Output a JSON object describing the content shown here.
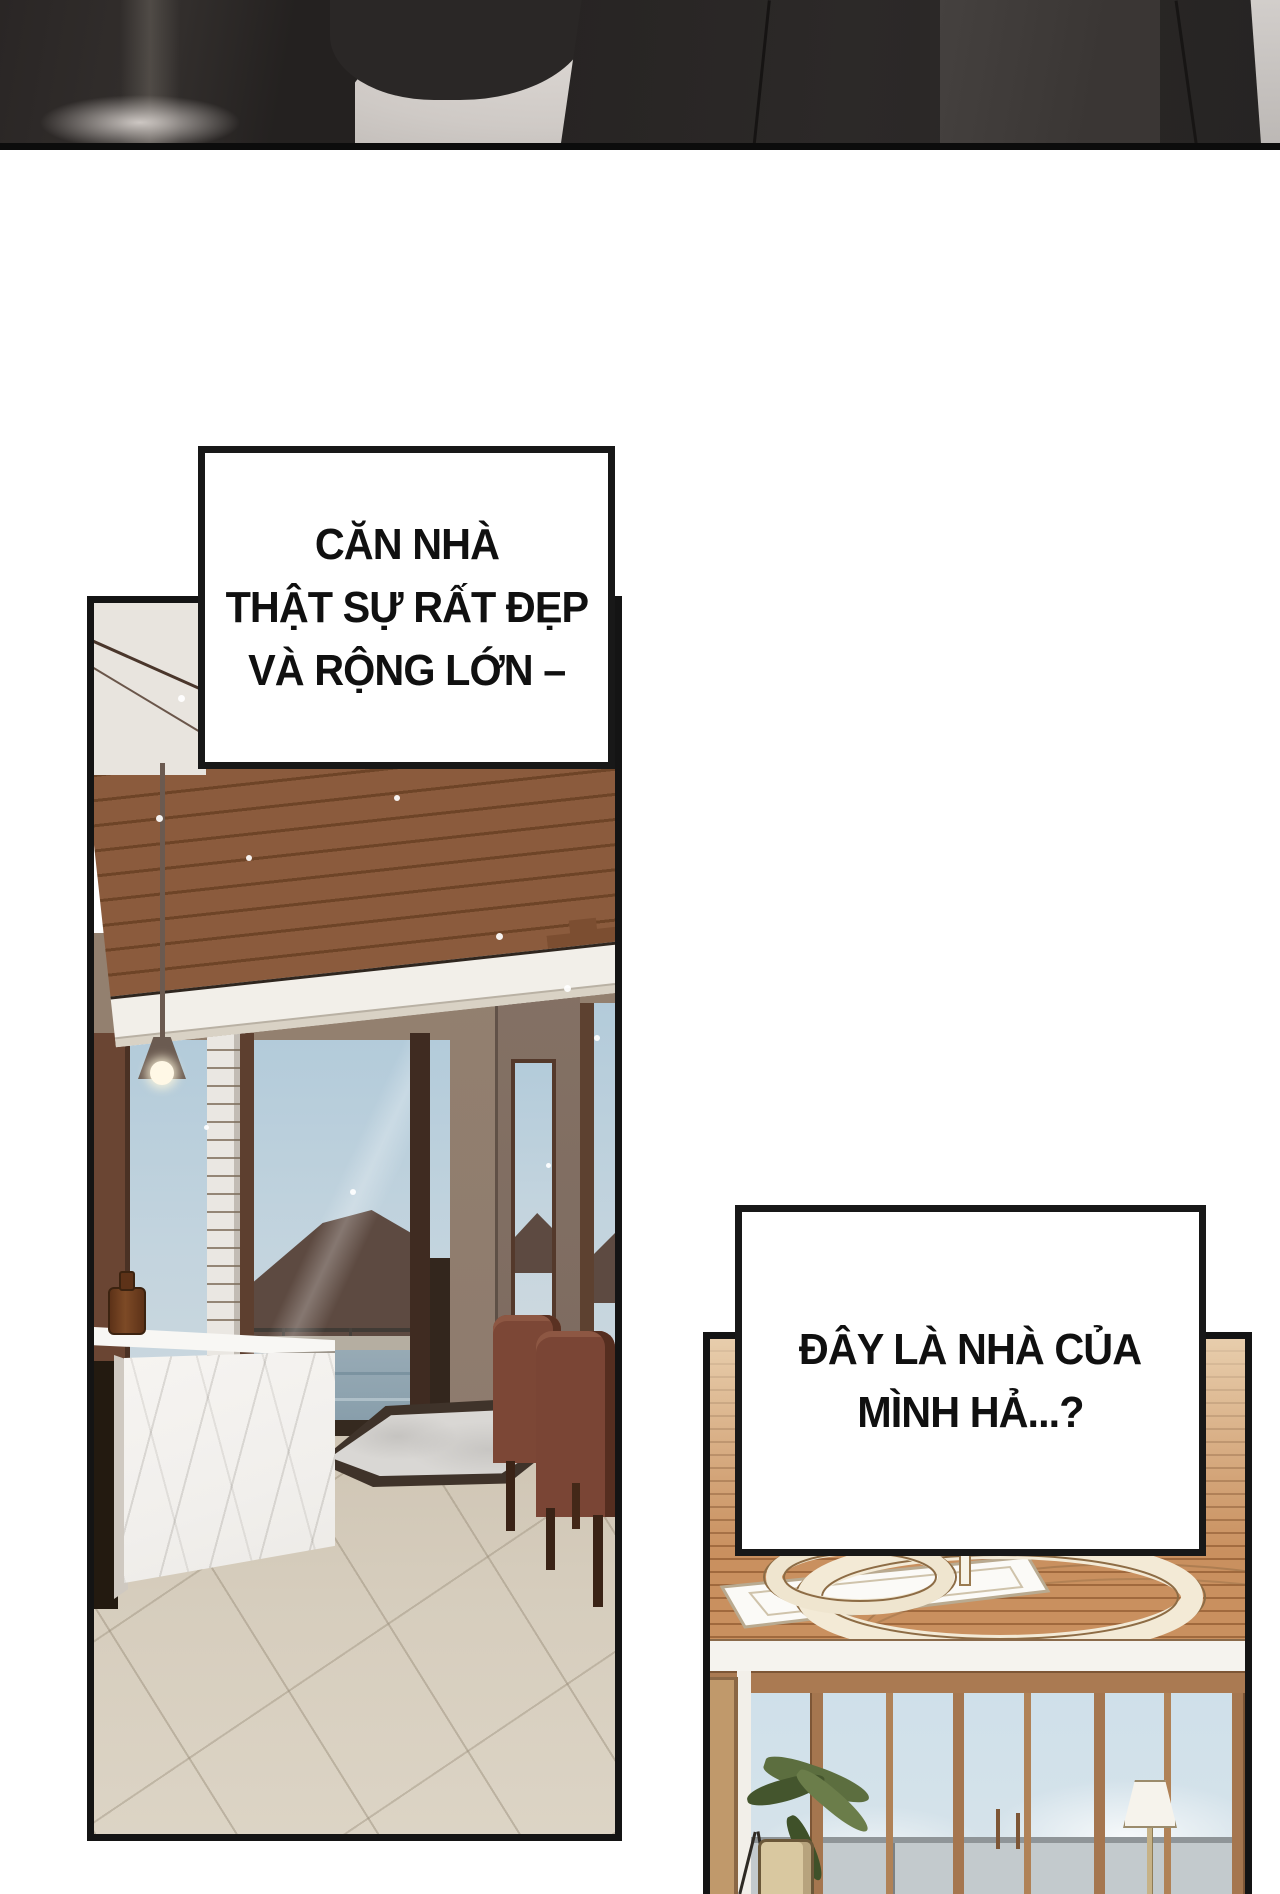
{
  "page": {
    "width": 1280,
    "height": 1894,
    "background": "#ffffff"
  },
  "top_panel": {
    "description": "blurred close-up of dark clothed figures",
    "border_color": "#0c0c0c"
  },
  "captions": {
    "box1": {
      "lines": [
        "CĂN NHÀ",
        "THẬT SỰ RẤT ĐẸP",
        "VÀ RỘNG LỚN –"
      ]
    },
    "box2": {
      "lines": [
        "ĐÂY LÀ NHÀ CỦA",
        "MÌNH HẢ...?"
      ]
    }
  },
  "palette": {
    "panel_border": "#141414",
    "caption_text": "#101010",
    "wood_ceiling_dark": "#8b5b3d",
    "wood_ceiling_light": "#c9905f",
    "stone_pillar": "#8e7b6e",
    "sky_glass": "#c3d4de",
    "hill": "#5d4a41",
    "pool": "#8ea3af",
    "marble": "#f3f1ed",
    "floor_tile": "#d6cdbd",
    "chair": "#7c4736",
    "rug_border": "#3f332a",
    "sky_panel2": "#cfdfe9",
    "wardrobe": "#c0996b",
    "chandelier": "#f3ead6"
  }
}
